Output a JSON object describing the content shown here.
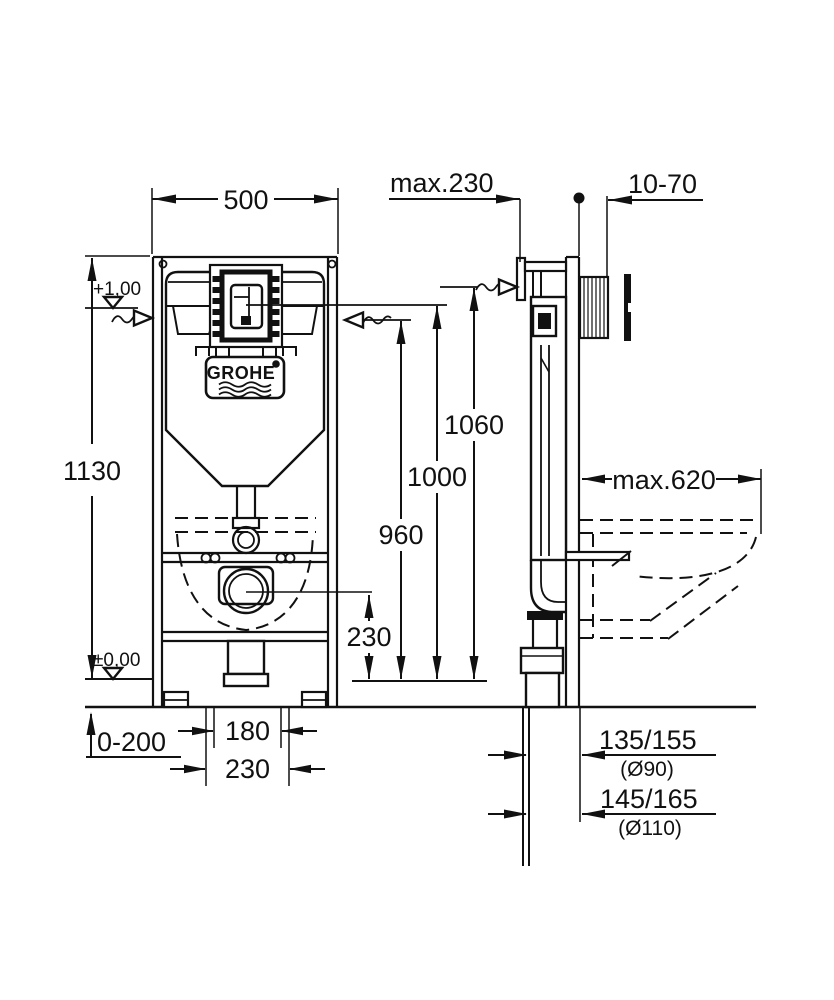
{
  "drawing": {
    "type": "concealed-cistern-installation-drawing",
    "brand_logo": "GROHE",
    "front_view": {
      "frame_width": "500",
      "total_height": "1130",
      "level_upper": "+1,00",
      "level_floor": "±0,00",
      "foot_adjust_range": "0-200",
      "bolt_spacing": "180",
      "outer_spacing": "230",
      "drain_height": "230",
      "height_1060": "1060",
      "height_1000": "1000",
      "height_960": "960"
    },
    "side_view": {
      "max_depth": "max.230",
      "wall_finish_thickness": "10-70",
      "max_outreach": "max.620",
      "drain_offset_small": "135/155",
      "drain_dia_small": "(Ø90)",
      "drain_offset_large": "145/165",
      "drain_dia_large": "(Ø110)"
    }
  }
}
